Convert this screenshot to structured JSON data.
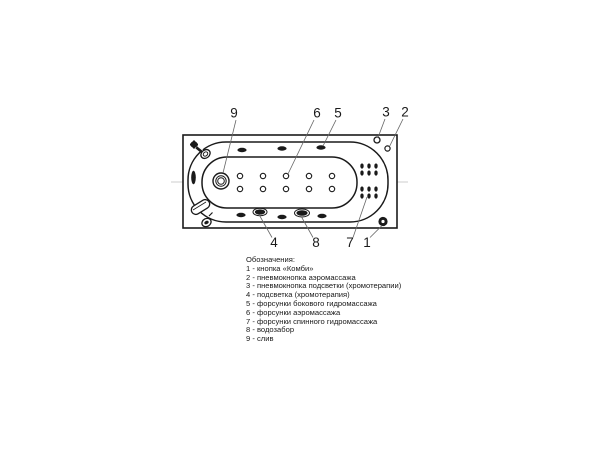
{
  "figure": {
    "kind": "bathtub-top-view-technical-diagram",
    "background_color": "#ffffff",
    "line_color": "#1a1a1a",
    "centerline_color": "#9a9a9a",
    "leader_color": "#666666"
  },
  "callouts": {
    "top": [
      "9",
      "6",
      "5",
      "3",
      "2"
    ],
    "bottom": [
      "4",
      "8",
      "7",
      "1"
    ]
  },
  "legend": {
    "heading": "Обозначения:",
    "items": [
      "1 - кнопка «Комби»",
      "2 - пневмокнопка аэромассажа",
      "3 - пневмокнопка подсветки (хромотерапии)",
      "4 - подсветка (хромотерапия)",
      "5 - форсунки бокового гидромассажа",
      "6 - форсунки аэромассажа",
      "7 - форсунки спинного гидромассажа",
      "8 - водозабор",
      "9 - слив"
    ]
  }
}
